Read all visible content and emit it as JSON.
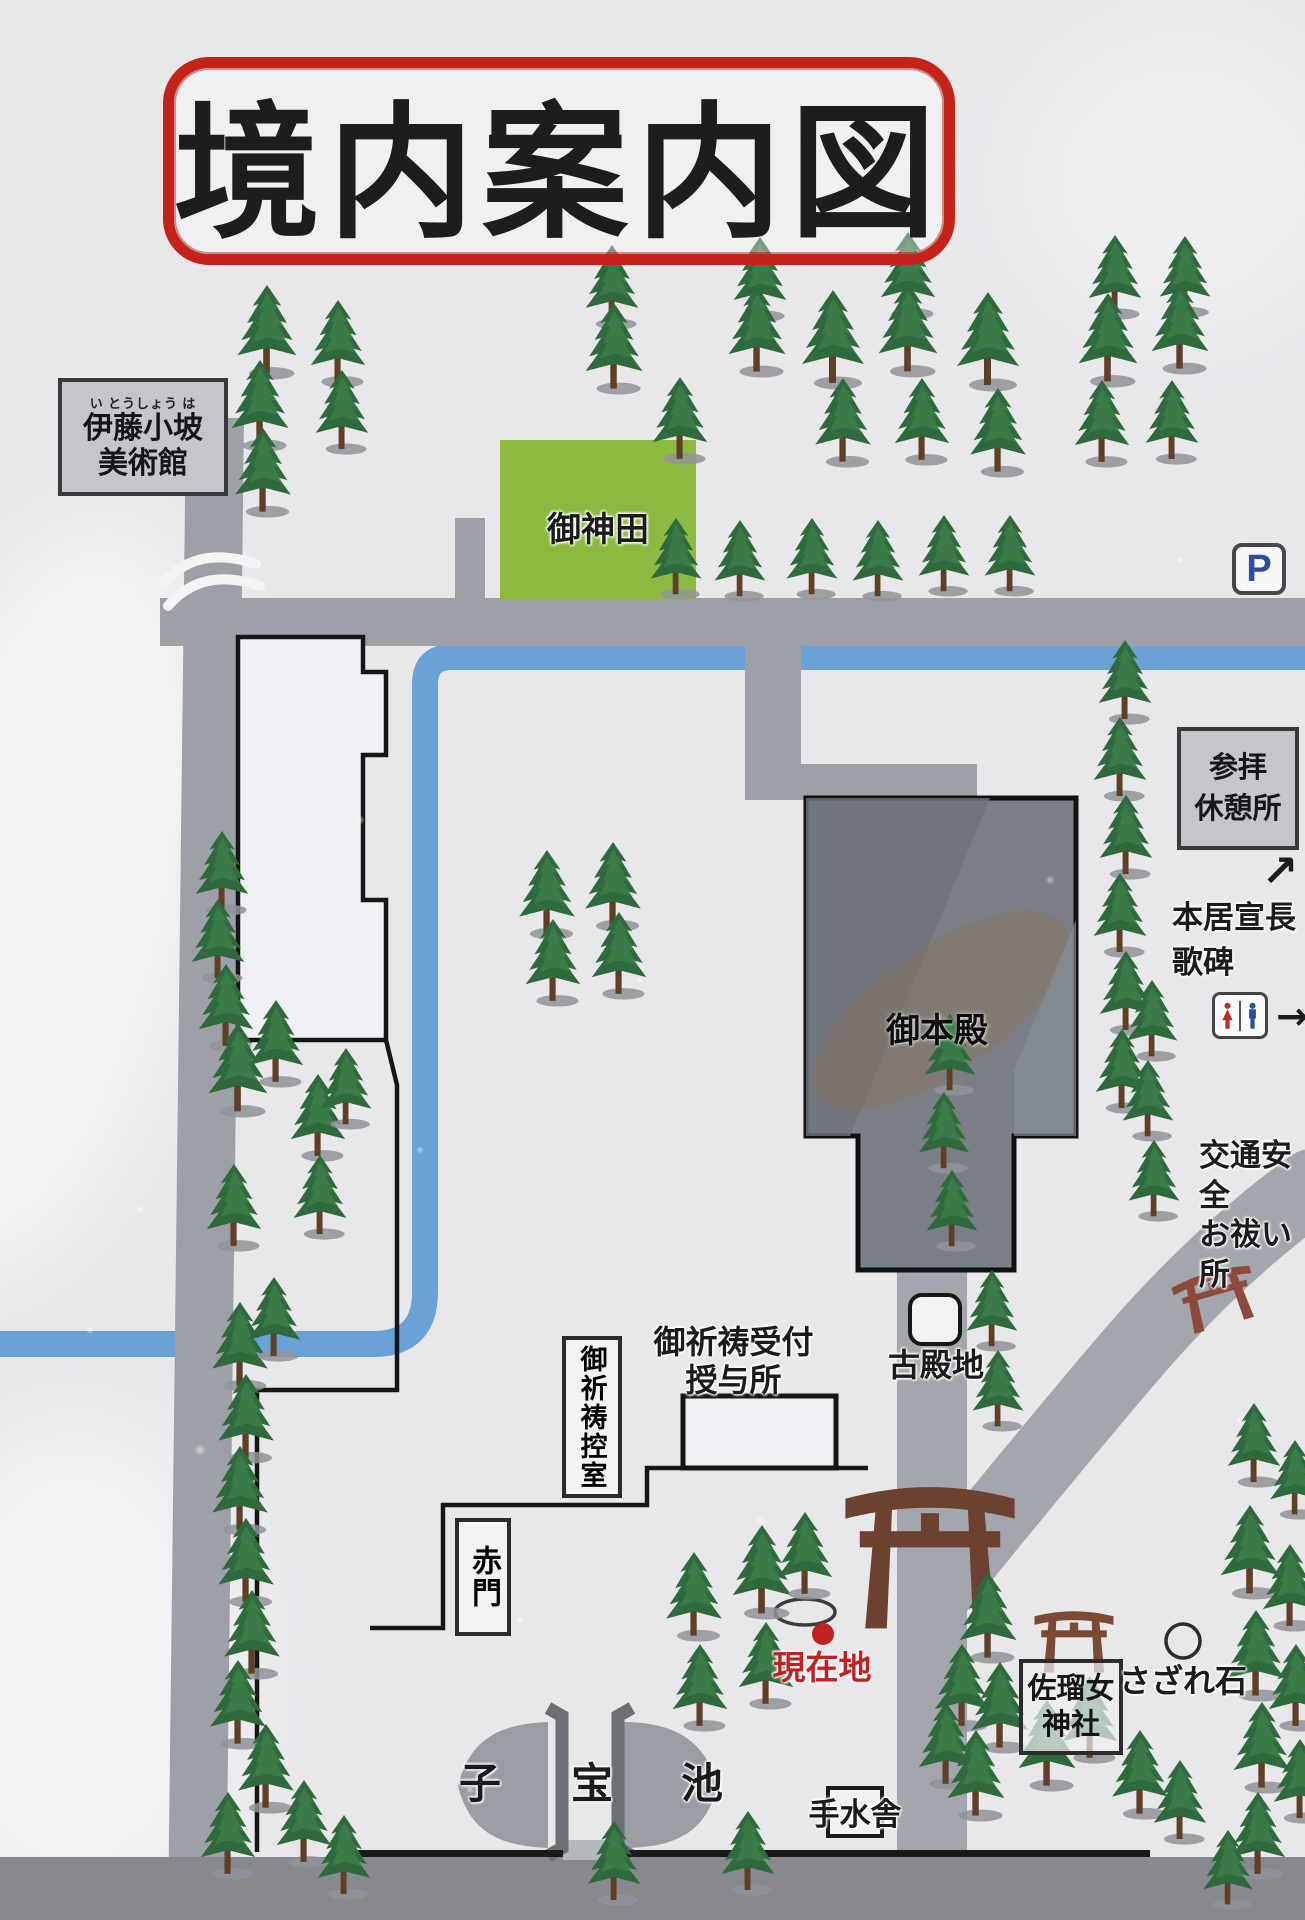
{
  "title": "境内案内図",
  "museum": {
    "furigana": "い とうしょう は",
    "line1": "伊藤小坡",
    "line2": "美術館"
  },
  "field_label": "御神田",
  "parking_label": "P",
  "rest_area": {
    "line1": "参拝",
    "line2": "休憩所"
  },
  "monument": {
    "line1": "本居宣長",
    "line2": "歌碑",
    "arrow": "↗"
  },
  "restroom": {
    "arrow": "→"
  },
  "purification": {
    "line1": "交通安全",
    "line2": "お祓い所"
  },
  "honden_label": "御本殿",
  "kodenchi_label": "古殿地",
  "reception": {
    "line1": "御祈祷受付",
    "line2": "授与所"
  },
  "waiting_room_label": "御祈祷控室",
  "akamon_label": "赤門",
  "current_location_label": "現在地",
  "sarume": {
    "line1": "佐瑠女",
    "line2": "神社"
  },
  "sazare_label": "さざれ石",
  "temizu_label": "手水舎",
  "pond": {
    "char1": "子",
    "char2": "宝",
    "char3": "池"
  },
  "colors": {
    "title_red": "#c5231a",
    "location_red": "#c42020",
    "field_green": "#8cba40",
    "river_blue": "#6aa1d6",
    "parking_blue": "#2a4fa0",
    "honden_gray": "#7a7f86"
  },
  "map": {
    "trees": [
      [
        267,
        380,
        0.95
      ],
      [
        338,
        388,
        0.88
      ],
      [
        260,
        452,
        0.92
      ],
      [
        342,
        455,
        0.85
      ],
      [
        263,
        518,
        0.9
      ],
      [
        612,
        330,
        0.85
      ],
      [
        760,
        322,
        0.85
      ],
      [
        908,
        320,
        0.88
      ],
      [
        1115,
        320,
        0.85
      ],
      [
        1185,
        318,
        0.82
      ],
      [
        614,
        395,
        0.92
      ],
      [
        757,
        378,
        0.92
      ],
      [
        833,
        390,
        1.0
      ],
      [
        908,
        378,
        0.95
      ],
      [
        988,
        392,
        1.0
      ],
      [
        680,
        465,
        0.88
      ],
      [
        843,
        468,
        0.9
      ],
      [
        922,
        466,
        0.88
      ],
      [
        998,
        478,
        0.9
      ],
      [
        1108,
        388,
        0.95
      ],
      [
        1180,
        375,
        0.92
      ],
      [
        1102,
        468,
        0.88
      ],
      [
        1172,
        465,
        0.85
      ],
      [
        676,
        600,
        0.82
      ],
      [
        740,
        602,
        0.82
      ],
      [
        812,
        600,
        0.82
      ],
      [
        878,
        602,
        0.82
      ],
      [
        944,
        597,
        0.82
      ],
      [
        1010,
        597,
        0.82
      ],
      [
        1125,
        725,
        0.85
      ],
      [
        1120,
        802,
        0.85
      ],
      [
        1126,
        880,
        0.85
      ],
      [
        1120,
        958,
        0.85
      ],
      [
        1126,
        1036,
        0.85
      ],
      [
        1122,
        1114,
        0.85
      ],
      [
        1152,
        1062,
        0.82
      ],
      [
        1148,
        1142,
        0.82
      ],
      [
        1154,
        1222,
        0.82
      ],
      [
        547,
        940,
        0.9
      ],
      [
        613,
        932,
        0.9
      ],
      [
        553,
        1007,
        0.88
      ],
      [
        619,
        1000,
        0.88
      ],
      [
        222,
        916,
        0.85
      ],
      [
        218,
        984,
        0.85
      ],
      [
        226,
        1052,
        0.88
      ],
      [
        238,
        1118,
        0.95
      ],
      [
        276,
        1088,
        0.88
      ],
      [
        318,
        1162,
        0.88
      ],
      [
        346,
        1130,
        0.82
      ],
      [
        234,
        1252,
        0.88
      ],
      [
        320,
        1240,
        0.85
      ],
      [
        240,
        1392,
        0.9
      ],
      [
        274,
        1362,
        0.85
      ],
      [
        246,
        1464,
        0.9
      ],
      [
        240,
        1536,
        0.9
      ],
      [
        246,
        1608,
        0.9
      ],
      [
        252,
        1680,
        0.9
      ],
      [
        238,
        1750,
        0.9
      ],
      [
        266,
        1814,
        0.9
      ],
      [
        304,
        1868,
        0.88
      ],
      [
        344,
        1900,
        0.85
      ],
      [
        228,
        1880,
        0.88
      ],
      [
        950,
        1096,
        0.82
      ],
      [
        944,
        1174,
        0.82
      ],
      [
        952,
        1252,
        0.82
      ],
      [
        992,
        1352,
        0.82
      ],
      [
        998,
        1432,
        0.82
      ],
      [
        694,
        1642,
        0.9
      ],
      [
        762,
        1620,
        0.95
      ],
      [
        700,
        1732,
        0.88
      ],
      [
        766,
        1710,
        0.88
      ],
      [
        805,
        1600,
        0.88
      ],
      [
        614,
        1906,
        0.85
      ],
      [
        748,
        1896,
        0.85
      ],
      [
        988,
        1664,
        0.92
      ],
      [
        962,
        1732,
        0.88
      ],
      [
        1000,
        1754,
        0.92
      ],
      [
        946,
        1790,
        0.88
      ],
      [
        976,
        1822,
        0.92
      ],
      [
        1047,
        1792,
        0.92
      ],
      [
        1090,
        1764,
        0.88
      ],
      [
        1140,
        1820,
        0.9
      ],
      [
        1180,
        1845,
        0.85
      ],
      [
        1254,
        1488,
        0.85
      ],
      [
        1295,
        1520,
        0.8
      ],
      [
        1250,
        1600,
        0.95
      ],
      [
        1290,
        1632,
        0.88
      ],
      [
        1256,
        1702,
        0.92
      ],
      [
        1296,
        1732,
        0.88
      ],
      [
        1262,
        1794,
        0.92
      ],
      [
        1300,
        1824,
        0.85
      ],
      [
        1258,
        1880,
        0.88
      ],
      [
        1228,
        1910,
        0.8
      ]
    ],
    "torii": [
      {
        "x": 840,
        "y": 1452,
        "w": 180,
        "h": 180,
        "color": "#6d4130",
        "rot": 0
      },
      {
        "x": 1032,
        "y": 1596,
        "w": 84,
        "h": 78,
        "color": "#7a4a33",
        "rot": 0
      },
      {
        "x": 1172,
        "y": 1258,
        "w": 86,
        "h": 70,
        "color": "#8d4a3c",
        "rot": -16
      }
    ]
  }
}
